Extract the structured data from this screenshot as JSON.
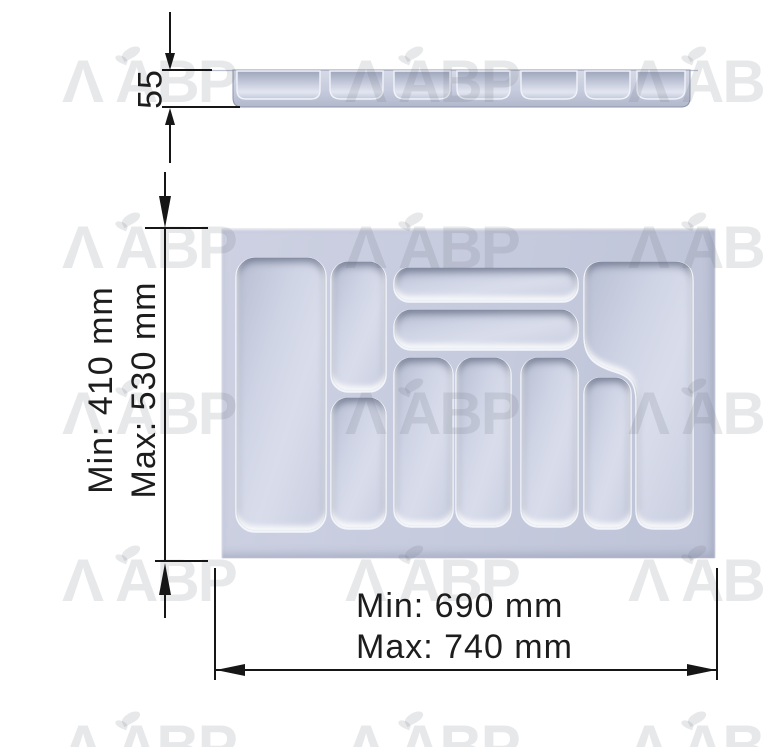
{
  "drawing": {
    "type": "cutlery-tray-technical-drawing",
    "watermark": {
      "lambda": "Λ",
      "text": "ABP"
    },
    "dimensions": {
      "height": {
        "value": "55"
      },
      "depth": {
        "min": "Min: 410 mm",
        "max": "Max: 530 mm"
      },
      "width": {
        "min": "Min: 690 mm",
        "max": "Max: 740 mm"
      }
    },
    "colors": {
      "tray_surface": "#c6cbdd",
      "compartment_floor": "#d2d7e7",
      "ridge_highlight": "#f2f5fb",
      "recess_shadow": "#5f6a86",
      "dimension_line": "#161616",
      "watermark": "rgba(106,111,124,0.16)"
    }
  }
}
